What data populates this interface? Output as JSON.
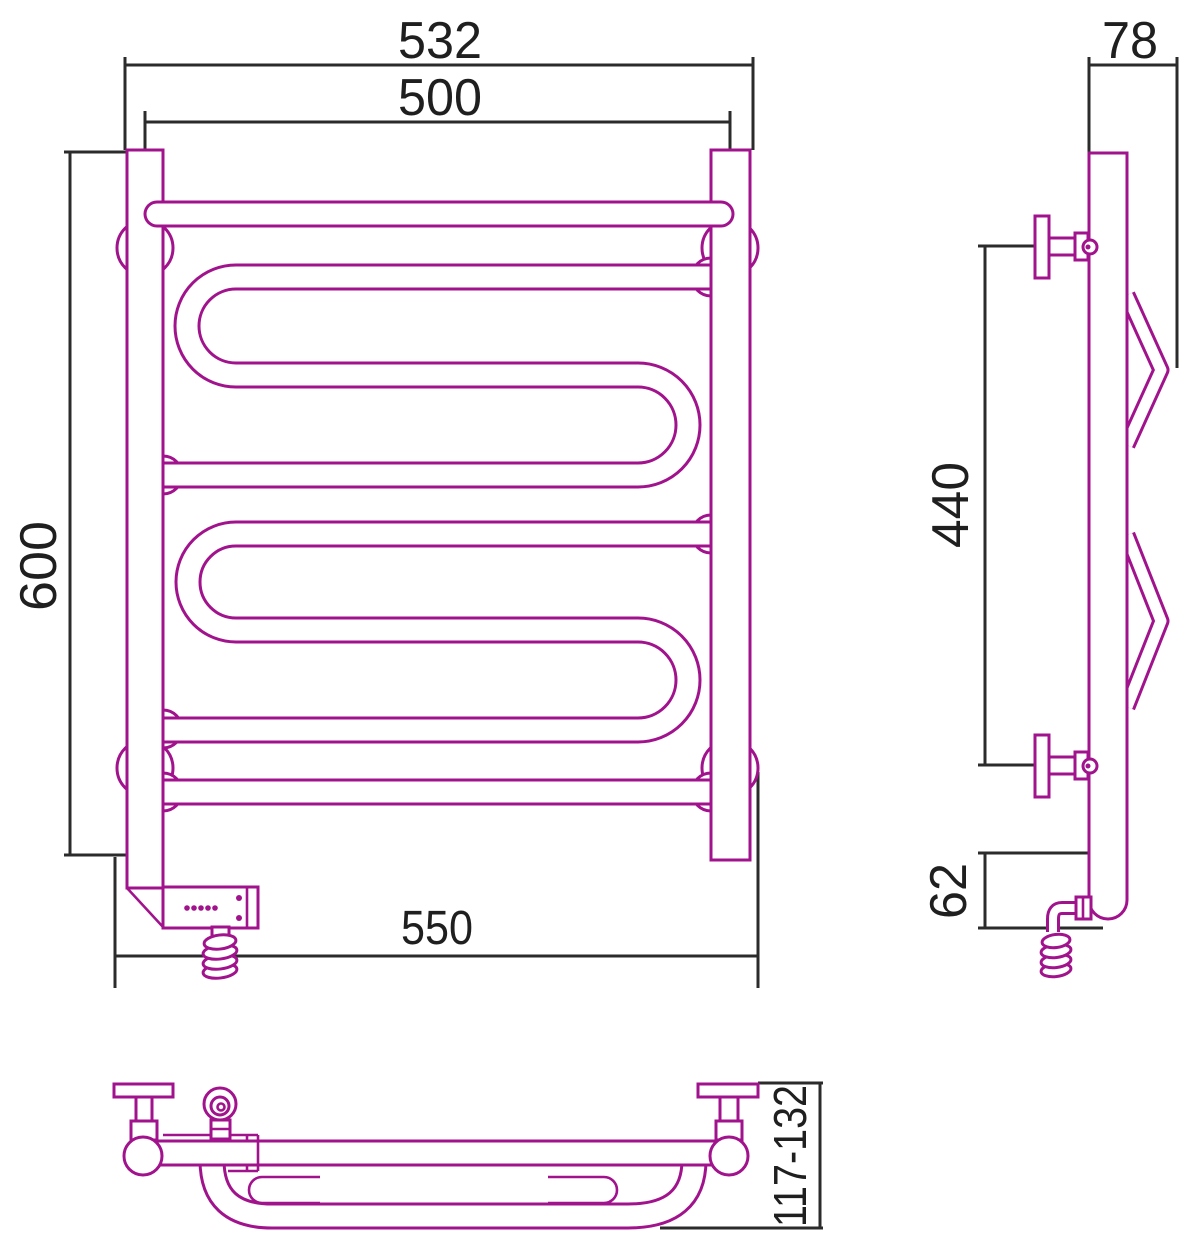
{
  "drawing": {
    "type": "technical-dimension-drawing",
    "subject": "electric heated towel rail, three orthographic views",
    "colors": {
      "product_line": "#a1138c",
      "dimension_line": "#2b2b2b",
      "background": "#ffffff",
      "text": "#1f1f1f"
    },
    "views": {
      "front": {
        "name": "front-view"
      },
      "side": {
        "name": "side-view"
      },
      "bottom": {
        "name": "bottom-plan-view"
      }
    },
    "dimensions": {
      "front_overall_width": "532",
      "front_rail_width": "500",
      "front_height": "600",
      "front_bracket_span": "550",
      "side_top_depth": "78",
      "side_bracket_spacing": "440",
      "side_bottom_offset": "62",
      "bottom_depth_range": "117-132"
    }
  }
}
